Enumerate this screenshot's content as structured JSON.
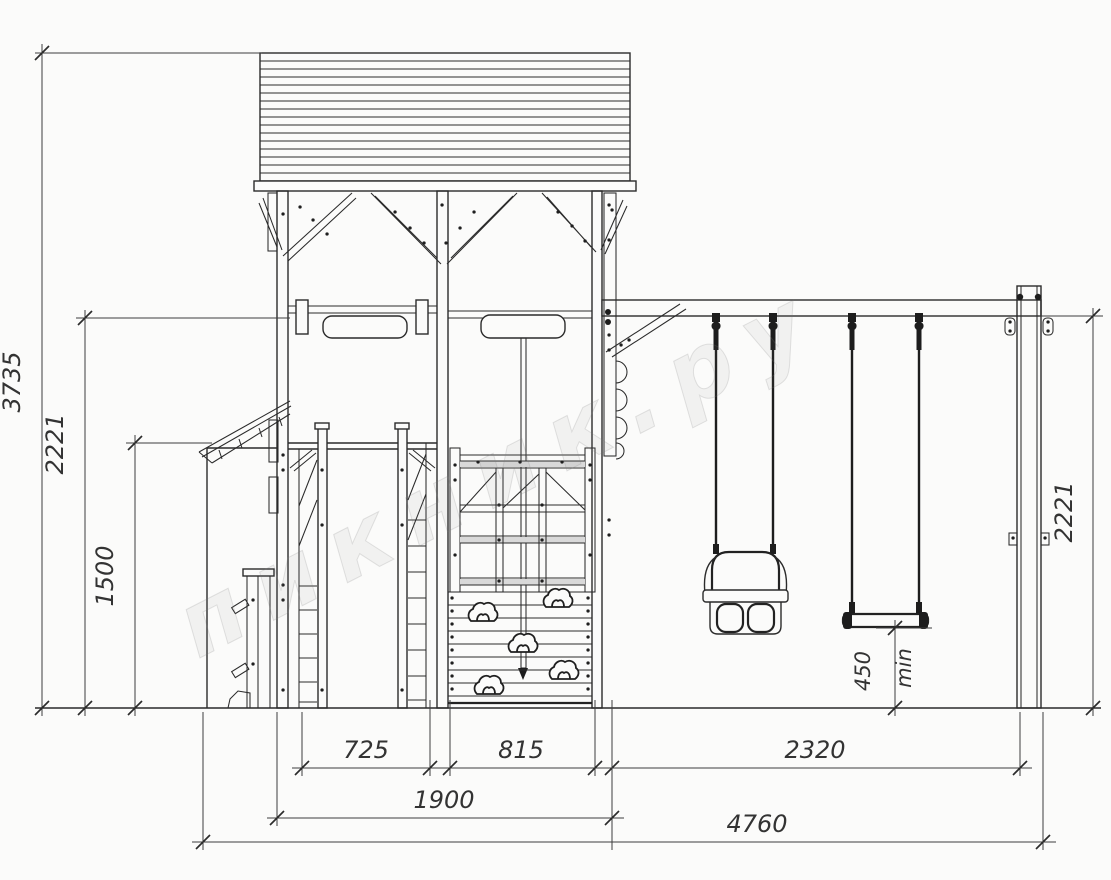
{
  "drawing": {
    "title": "playground-elevation-drawing",
    "watermark": {
      "text": "пикник.ру"
    },
    "colors": {
      "line": "#2b2b2b",
      "dim_text": "#333333",
      "background": "#fbfbfa",
      "watermark": "#7d7d7d"
    },
    "dims": {
      "total_height": "3735",
      "left_beam_height": "2221",
      "deck_height": "1500",
      "right_beam_height": "2221",
      "seat_clearance": "450",
      "seat_clearance_unit": "min",
      "slide_bay_width": "725",
      "climb_bay_width": "815",
      "tower_width": "1900",
      "swing_bay_width": "2320",
      "total_width": "4760"
    }
  }
}
